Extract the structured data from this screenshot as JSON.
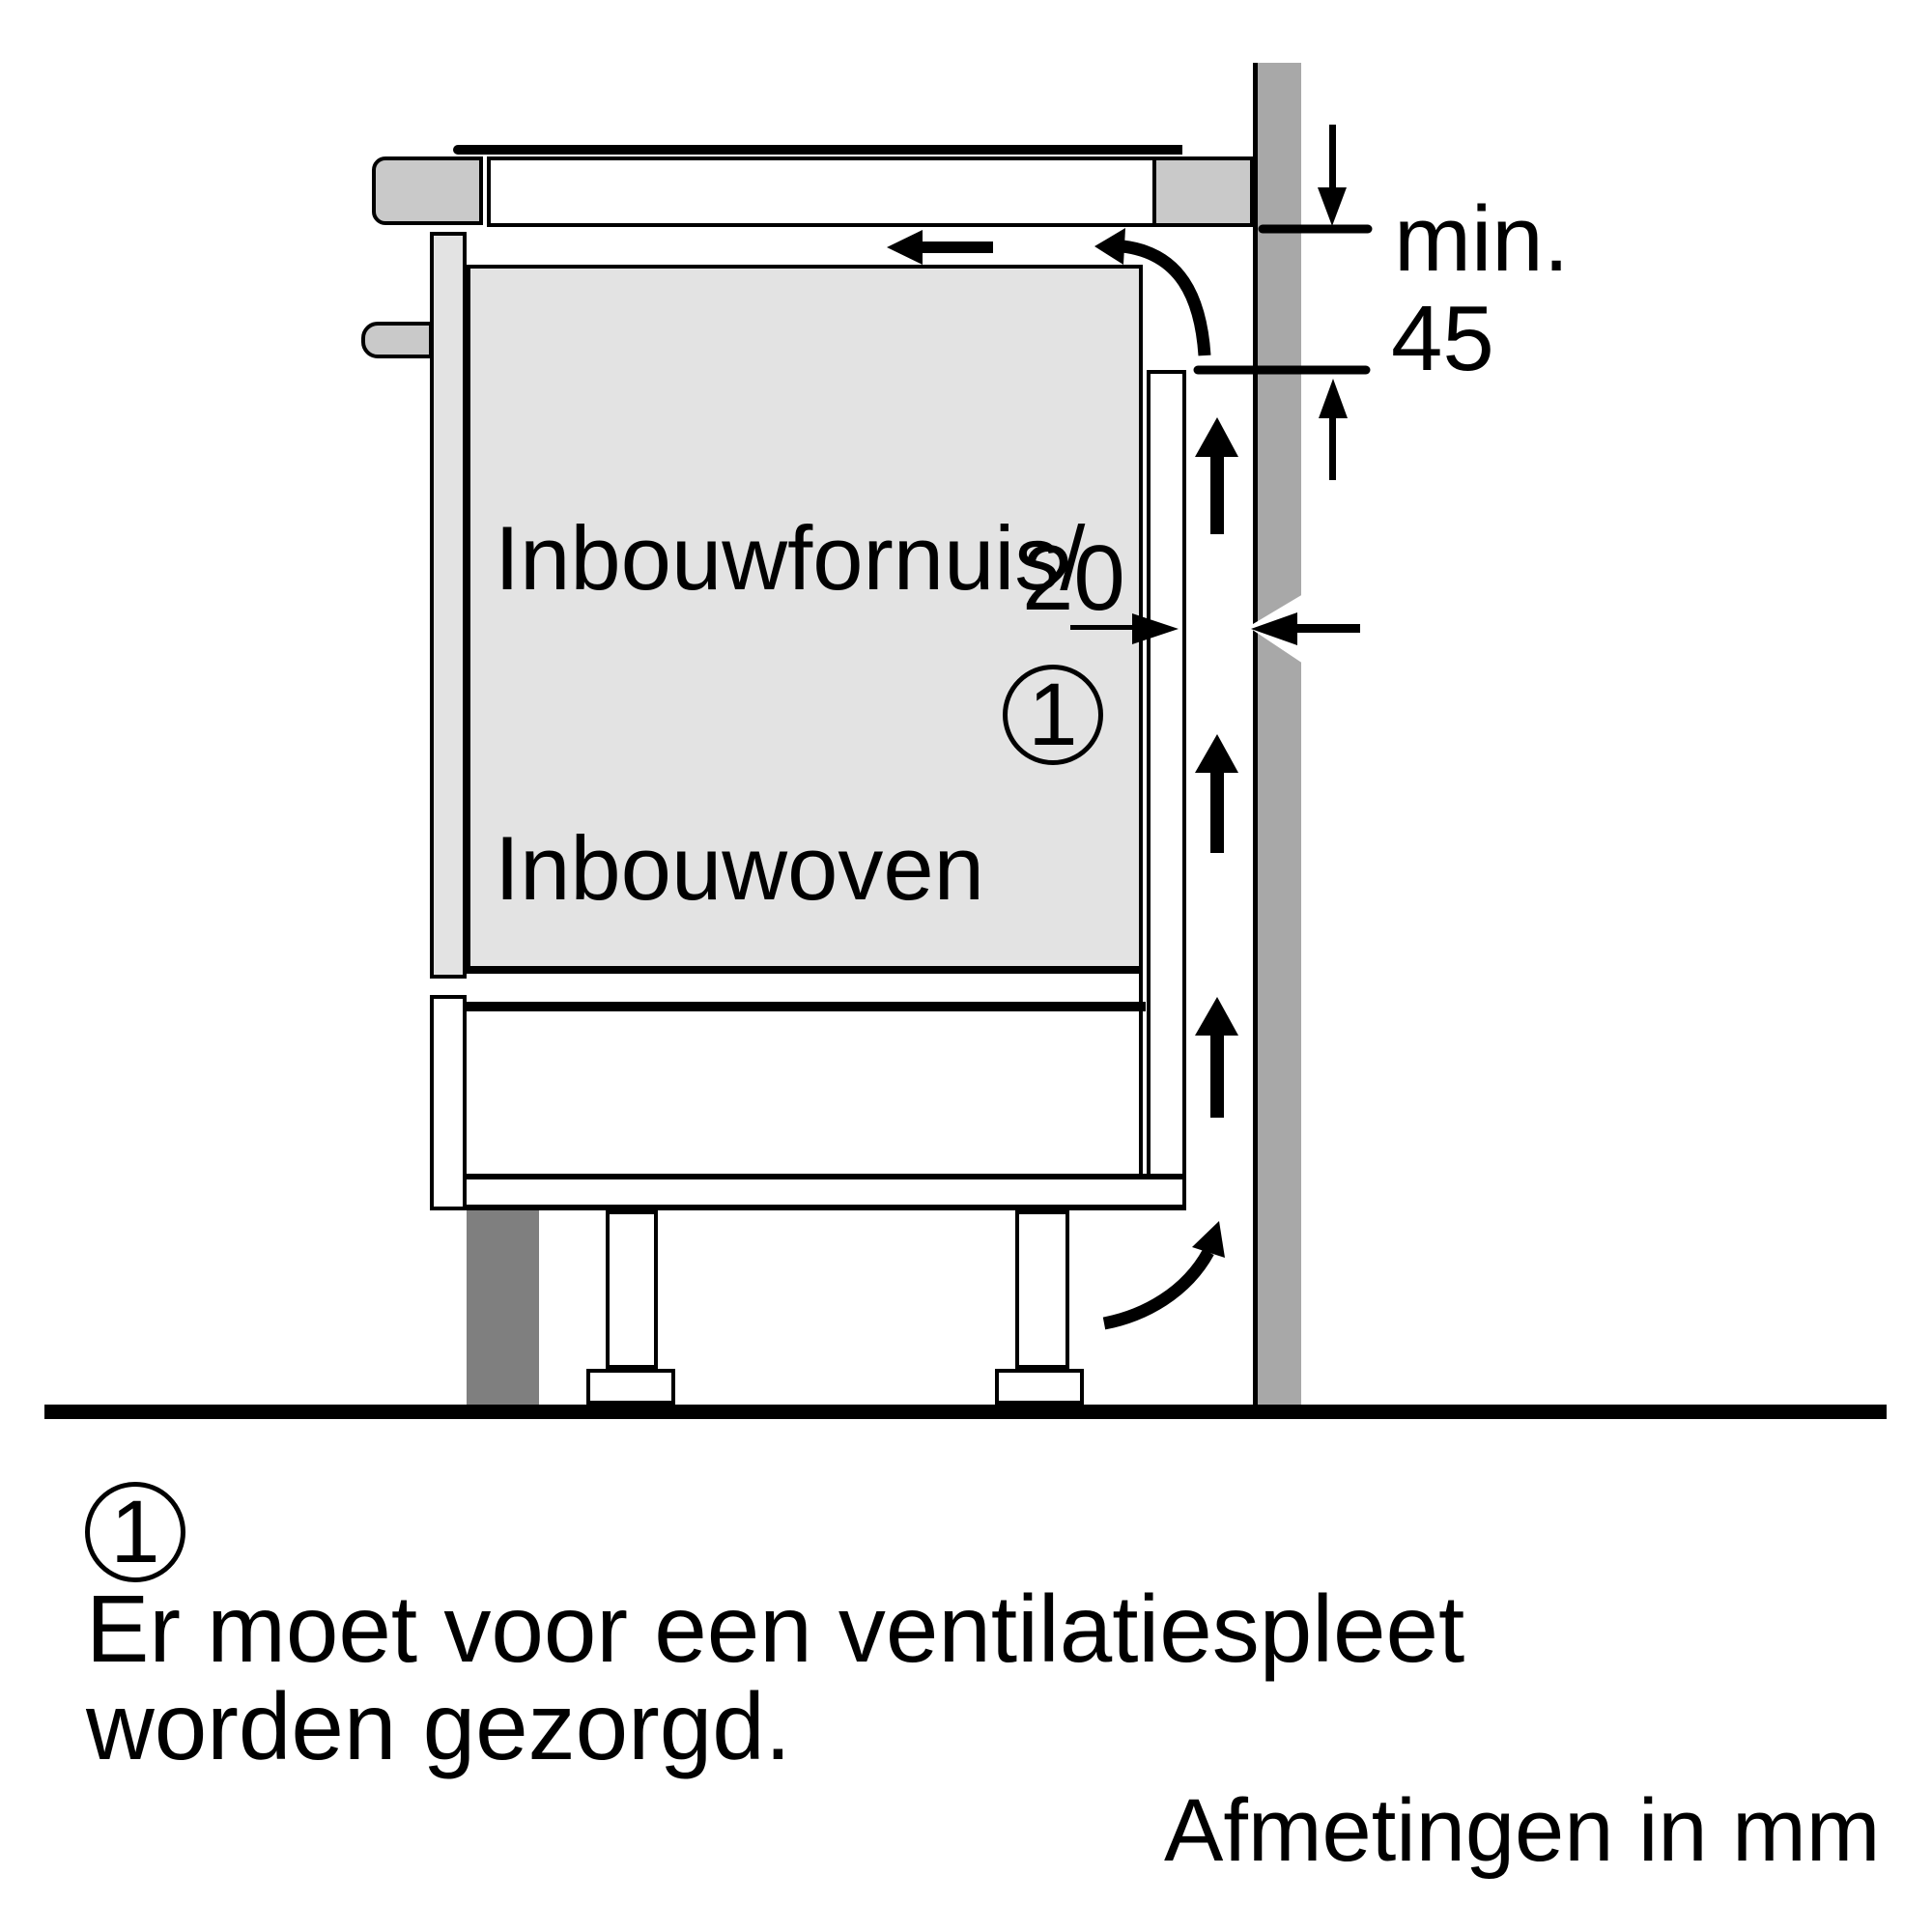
{
  "diagram": {
    "appliance_label": {
      "line1": "Inbouwfornuis/",
      "line2": "Inbouwoven"
    },
    "dimensions": {
      "min_label": "min.",
      "min_value": "45",
      "rear_gap_value": "20",
      "units": "mm"
    },
    "callout_number": "1",
    "colors": {
      "background": "#ffffff",
      "line": "#000000",
      "wall_gray": "#a8a8a8",
      "appliance_light_gray": "#e3e3e3",
      "trim_gray": "#c9c9c9",
      "plinth_dark_gray": "#7f7f7f"
    }
  },
  "footnote": {
    "number": "1",
    "line1": "Er moet voor een ventilatiespleet",
    "line2": "worden gezorgd.",
    "units_note": "Afmetingen in mm"
  }
}
